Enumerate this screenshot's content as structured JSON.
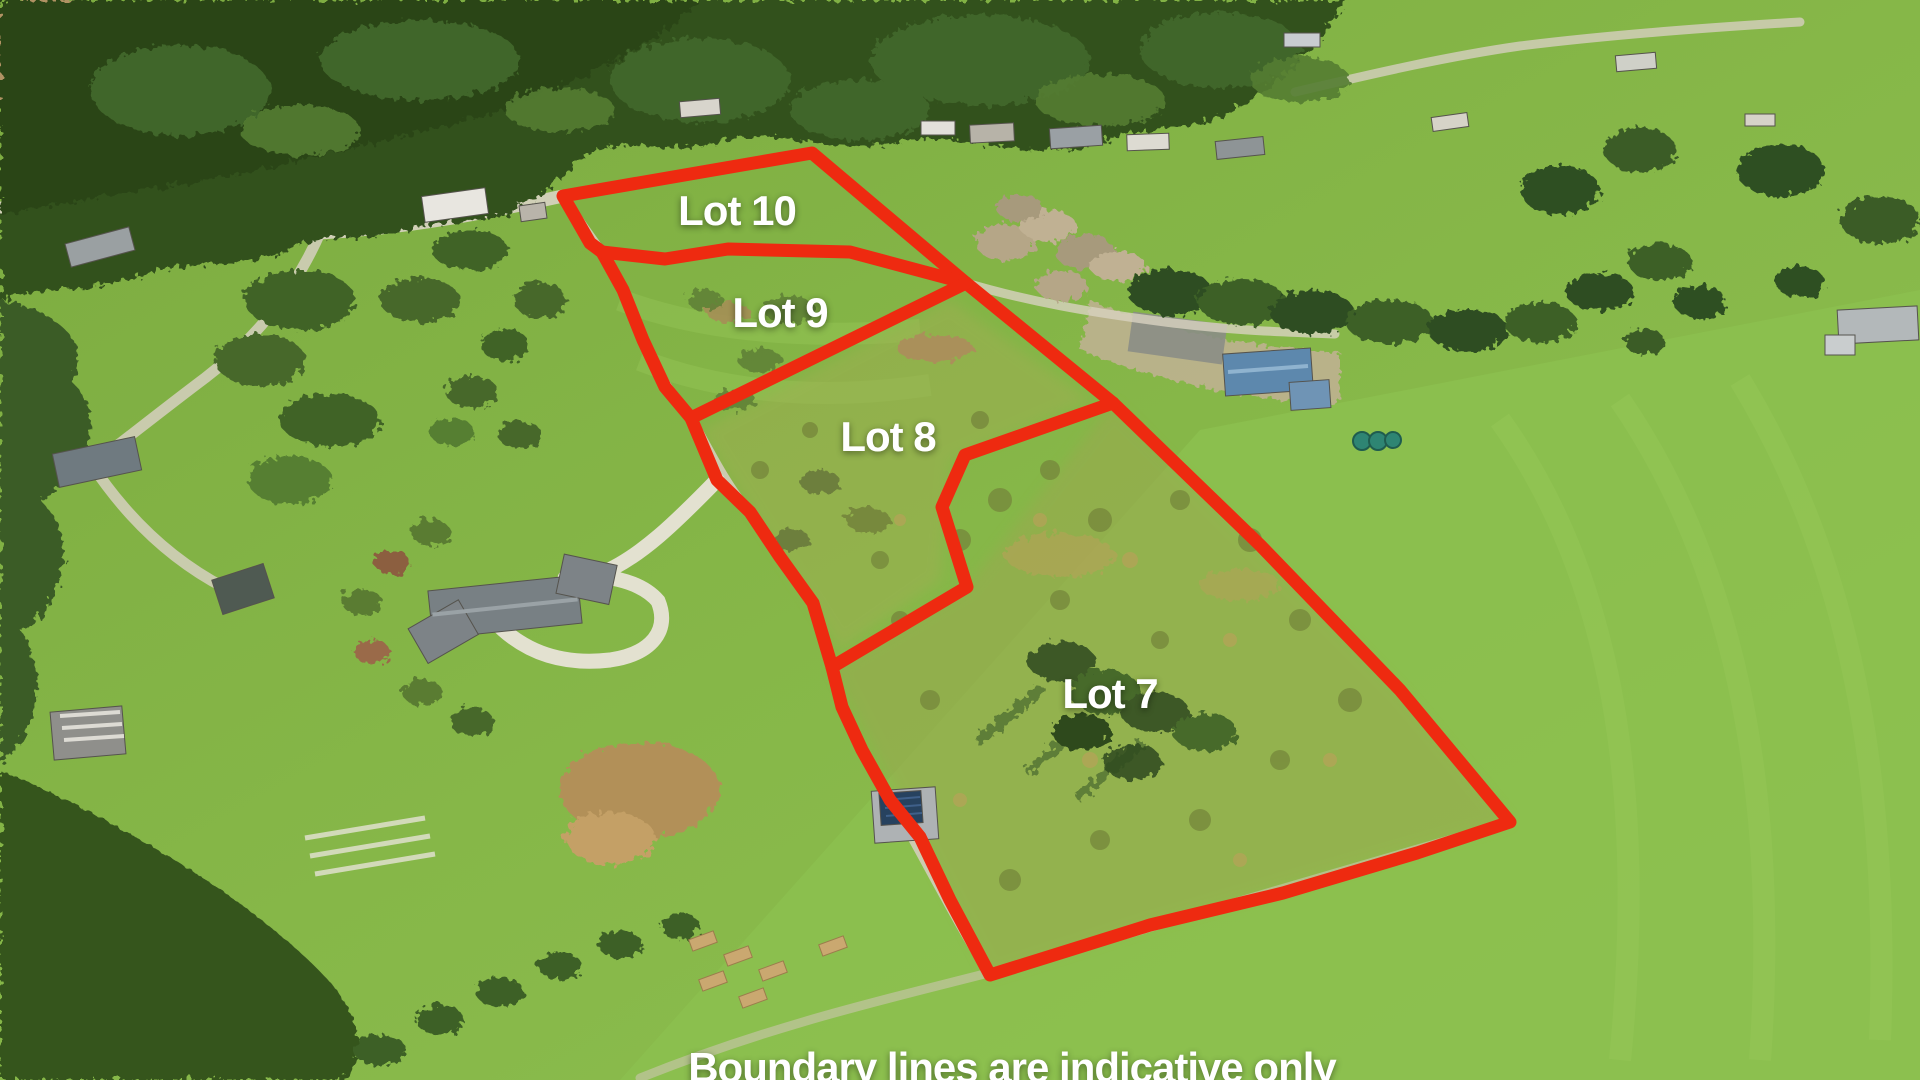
{
  "image": {
    "kind": "aerial-drone-photo-with-lot-overlay",
    "width": 1920,
    "height": 1080
  },
  "colors": {
    "boundary": "#ee2a10",
    "label_text": "#ffffff"
  },
  "overlay": {
    "stroke_width": 13,
    "disclaimer": {
      "text": "Boundary lines are indicative only",
      "x": 1012,
      "y": 1044
    },
    "lots": [
      {
        "id": "lot-10",
        "label": "Lot 10",
        "x": 737,
        "y": 211
      },
      {
        "id": "lot-9",
        "label": "Lot 9",
        "x": 780,
        "y": 313
      },
      {
        "id": "lot-8",
        "label": "Lot 8",
        "x": 888,
        "y": 437
      },
      {
        "id": "lot-7",
        "label": "Lot 7",
        "x": 1110,
        "y": 694
      }
    ],
    "boundaries": [
      {
        "name": "boundary-outer",
        "closed": true,
        "points": [
          [
            563,
            196
          ],
          [
            812,
            153
          ],
          [
            966,
            283
          ],
          [
            1113,
            403
          ],
          [
            1260,
            545
          ],
          [
            1400,
            690
          ],
          [
            1510,
            822
          ],
          [
            1417,
            853
          ],
          [
            1283,
            893
          ],
          [
            1150,
            925
          ],
          [
            990,
            975
          ],
          [
            950,
            900
          ],
          [
            920,
            837
          ],
          [
            890,
            800
          ],
          [
            862,
            750
          ],
          [
            842,
            707
          ],
          [
            832,
            667
          ],
          [
            813,
            603
          ],
          [
            780,
            557
          ],
          [
            750,
            512
          ],
          [
            717,
            480
          ],
          [
            691,
            418
          ],
          [
            665,
            387
          ],
          [
            643,
            340
          ],
          [
            623,
            290
          ],
          [
            602,
            252
          ],
          [
            590,
            243
          ],
          [
            578,
            222
          ]
        ]
      },
      {
        "name": "divider-lot10-lot9",
        "closed": false,
        "points": [
          [
            602,
            252
          ],
          [
            665,
            259
          ],
          [
            728,
            249
          ],
          [
            850,
            252
          ],
          [
            966,
            283
          ]
        ]
      },
      {
        "name": "divider-lot9-lot8",
        "closed": false,
        "points": [
          [
            691,
            418
          ],
          [
            966,
            283
          ]
        ]
      },
      {
        "name": "divider-lot8-lot7",
        "closed": false,
        "points": [
          [
            1113,
            403
          ],
          [
            965,
            455
          ],
          [
            942,
            507
          ],
          [
            967,
            587
          ],
          [
            832,
            667
          ]
        ]
      }
    ]
  }
}
